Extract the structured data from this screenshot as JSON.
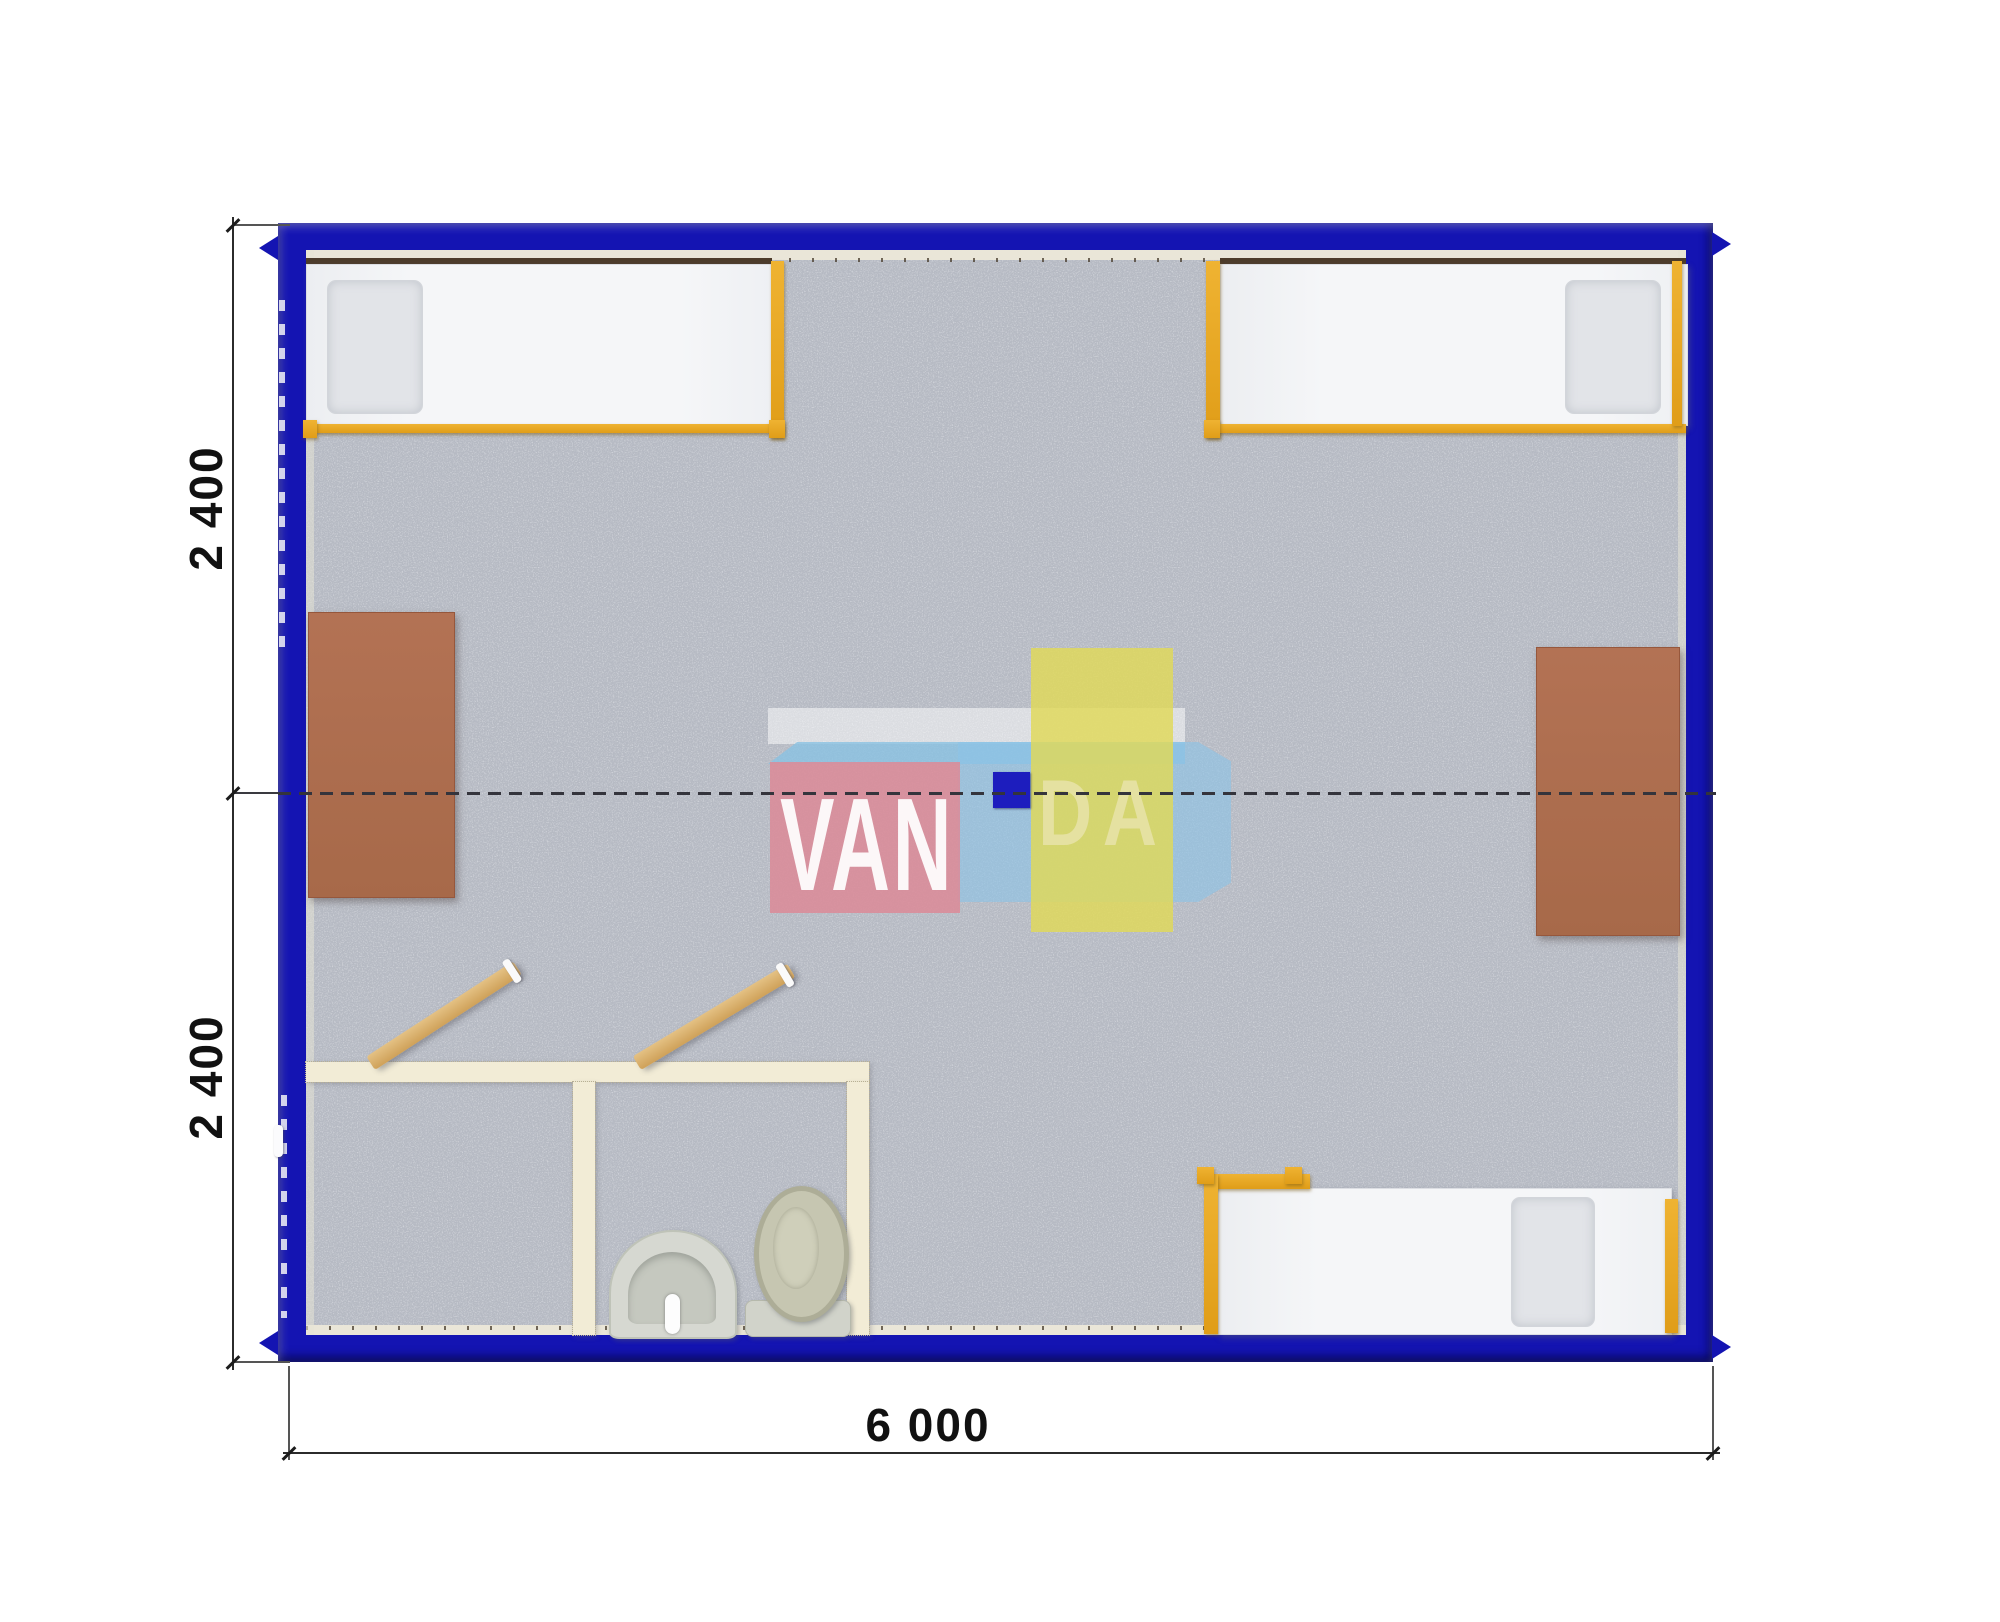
{
  "dimensions": {
    "left_top": "2 400",
    "left_bottom": "2 400",
    "bottom": "6 000"
  },
  "watermark": {
    "van": "VAN",
    "da": "DA",
    "full_text": "VANDA"
  },
  "colors": {
    "wall_blue": "#1414b2",
    "floor_gray": "#b6bac3",
    "bed_white": "#f5f6f8",
    "bed_frame_orange": "#e5a325",
    "bed_headrail_brown": "#4d3c2b",
    "desk_brown": "#ad6c4d",
    "partition_cream": "#f2ecd6",
    "door_wood": "#d9b36a",
    "fixture_gray": "#cfd1c6",
    "centerline": "#34343c",
    "watermark_pink": "#db8b98",
    "watermark_yellow": "#e1d958",
    "watermark_blue": "#8cc4e6",
    "watermark_navy": "#1d1dbe"
  },
  "plan": {
    "type": "container-cabin-floor-plan",
    "modules": 2,
    "beds": [
      "bed-top-left",
      "bed-top-right",
      "bed-bottom-right"
    ],
    "desks": [
      "desk-left",
      "desk-right"
    ],
    "bathroom": {
      "rooms": [
        "shower-room",
        "wc-room"
      ],
      "fixtures": [
        "sink",
        "toilet"
      ],
      "doors": [
        "door-shower-room",
        "door-wc-room"
      ]
    }
  }
}
